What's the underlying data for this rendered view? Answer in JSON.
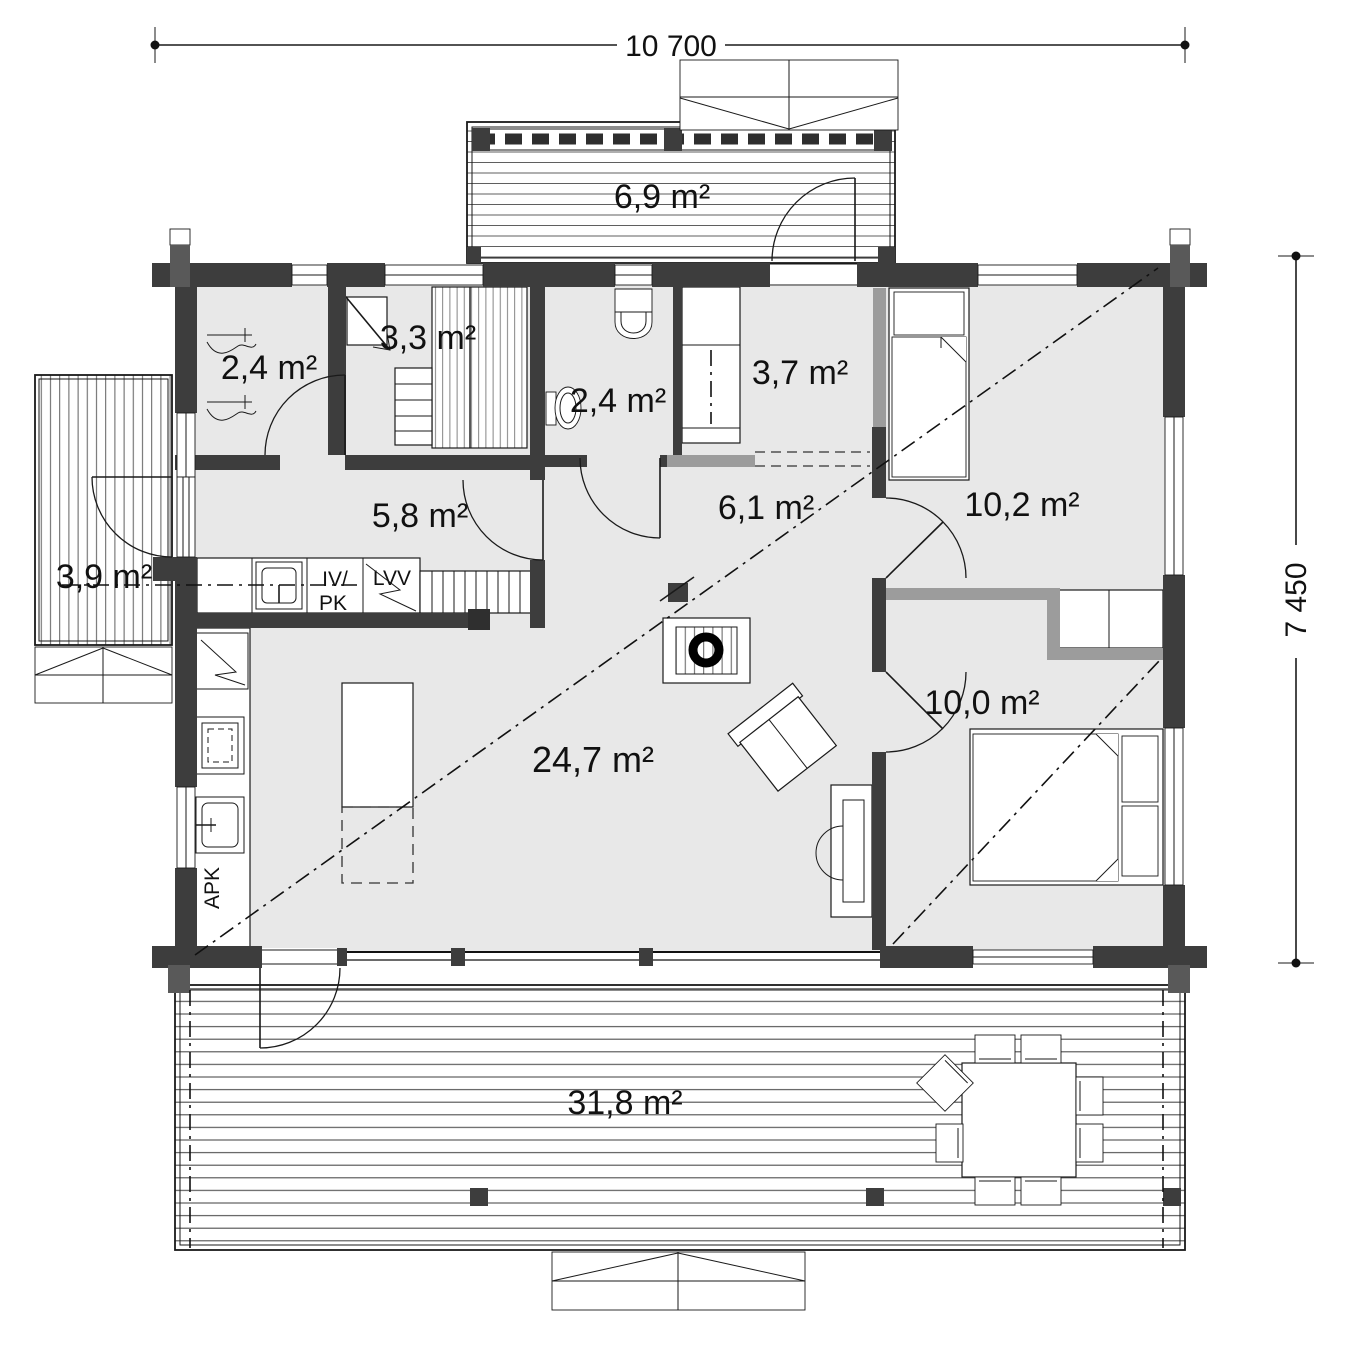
{
  "title": "log-house floor plan",
  "dimensions": {
    "width_label": "10 700",
    "height_label": "7 450"
  },
  "rooms": {
    "porch_north": "6,9 m²",
    "utility_nw": "2,4 m²",
    "sauna": "3,3 m²",
    "bathroom": "2,4 m²",
    "closet_entry": "3,7 m²",
    "bedroom_ne": "10,2 m²",
    "utility_room": "5,8 m²",
    "hallway": "6,1 m²",
    "terrace_west": "3,9 m²",
    "living_room": "24,7 m²",
    "bedroom_se": "10,0 m²",
    "terrace_south": "31,8 m²"
  },
  "appliances": {
    "vent_line1": "IV/",
    "vent_line2": "PK",
    "water_heater": "LVV",
    "dishwasher": "APK"
  },
  "colors": {
    "wall": "#3d3d3d",
    "partition": "#9c9c9c",
    "floor": "#e8e8e8",
    "deck_line": "#5f5f5f",
    "ink": "#111111"
  }
}
